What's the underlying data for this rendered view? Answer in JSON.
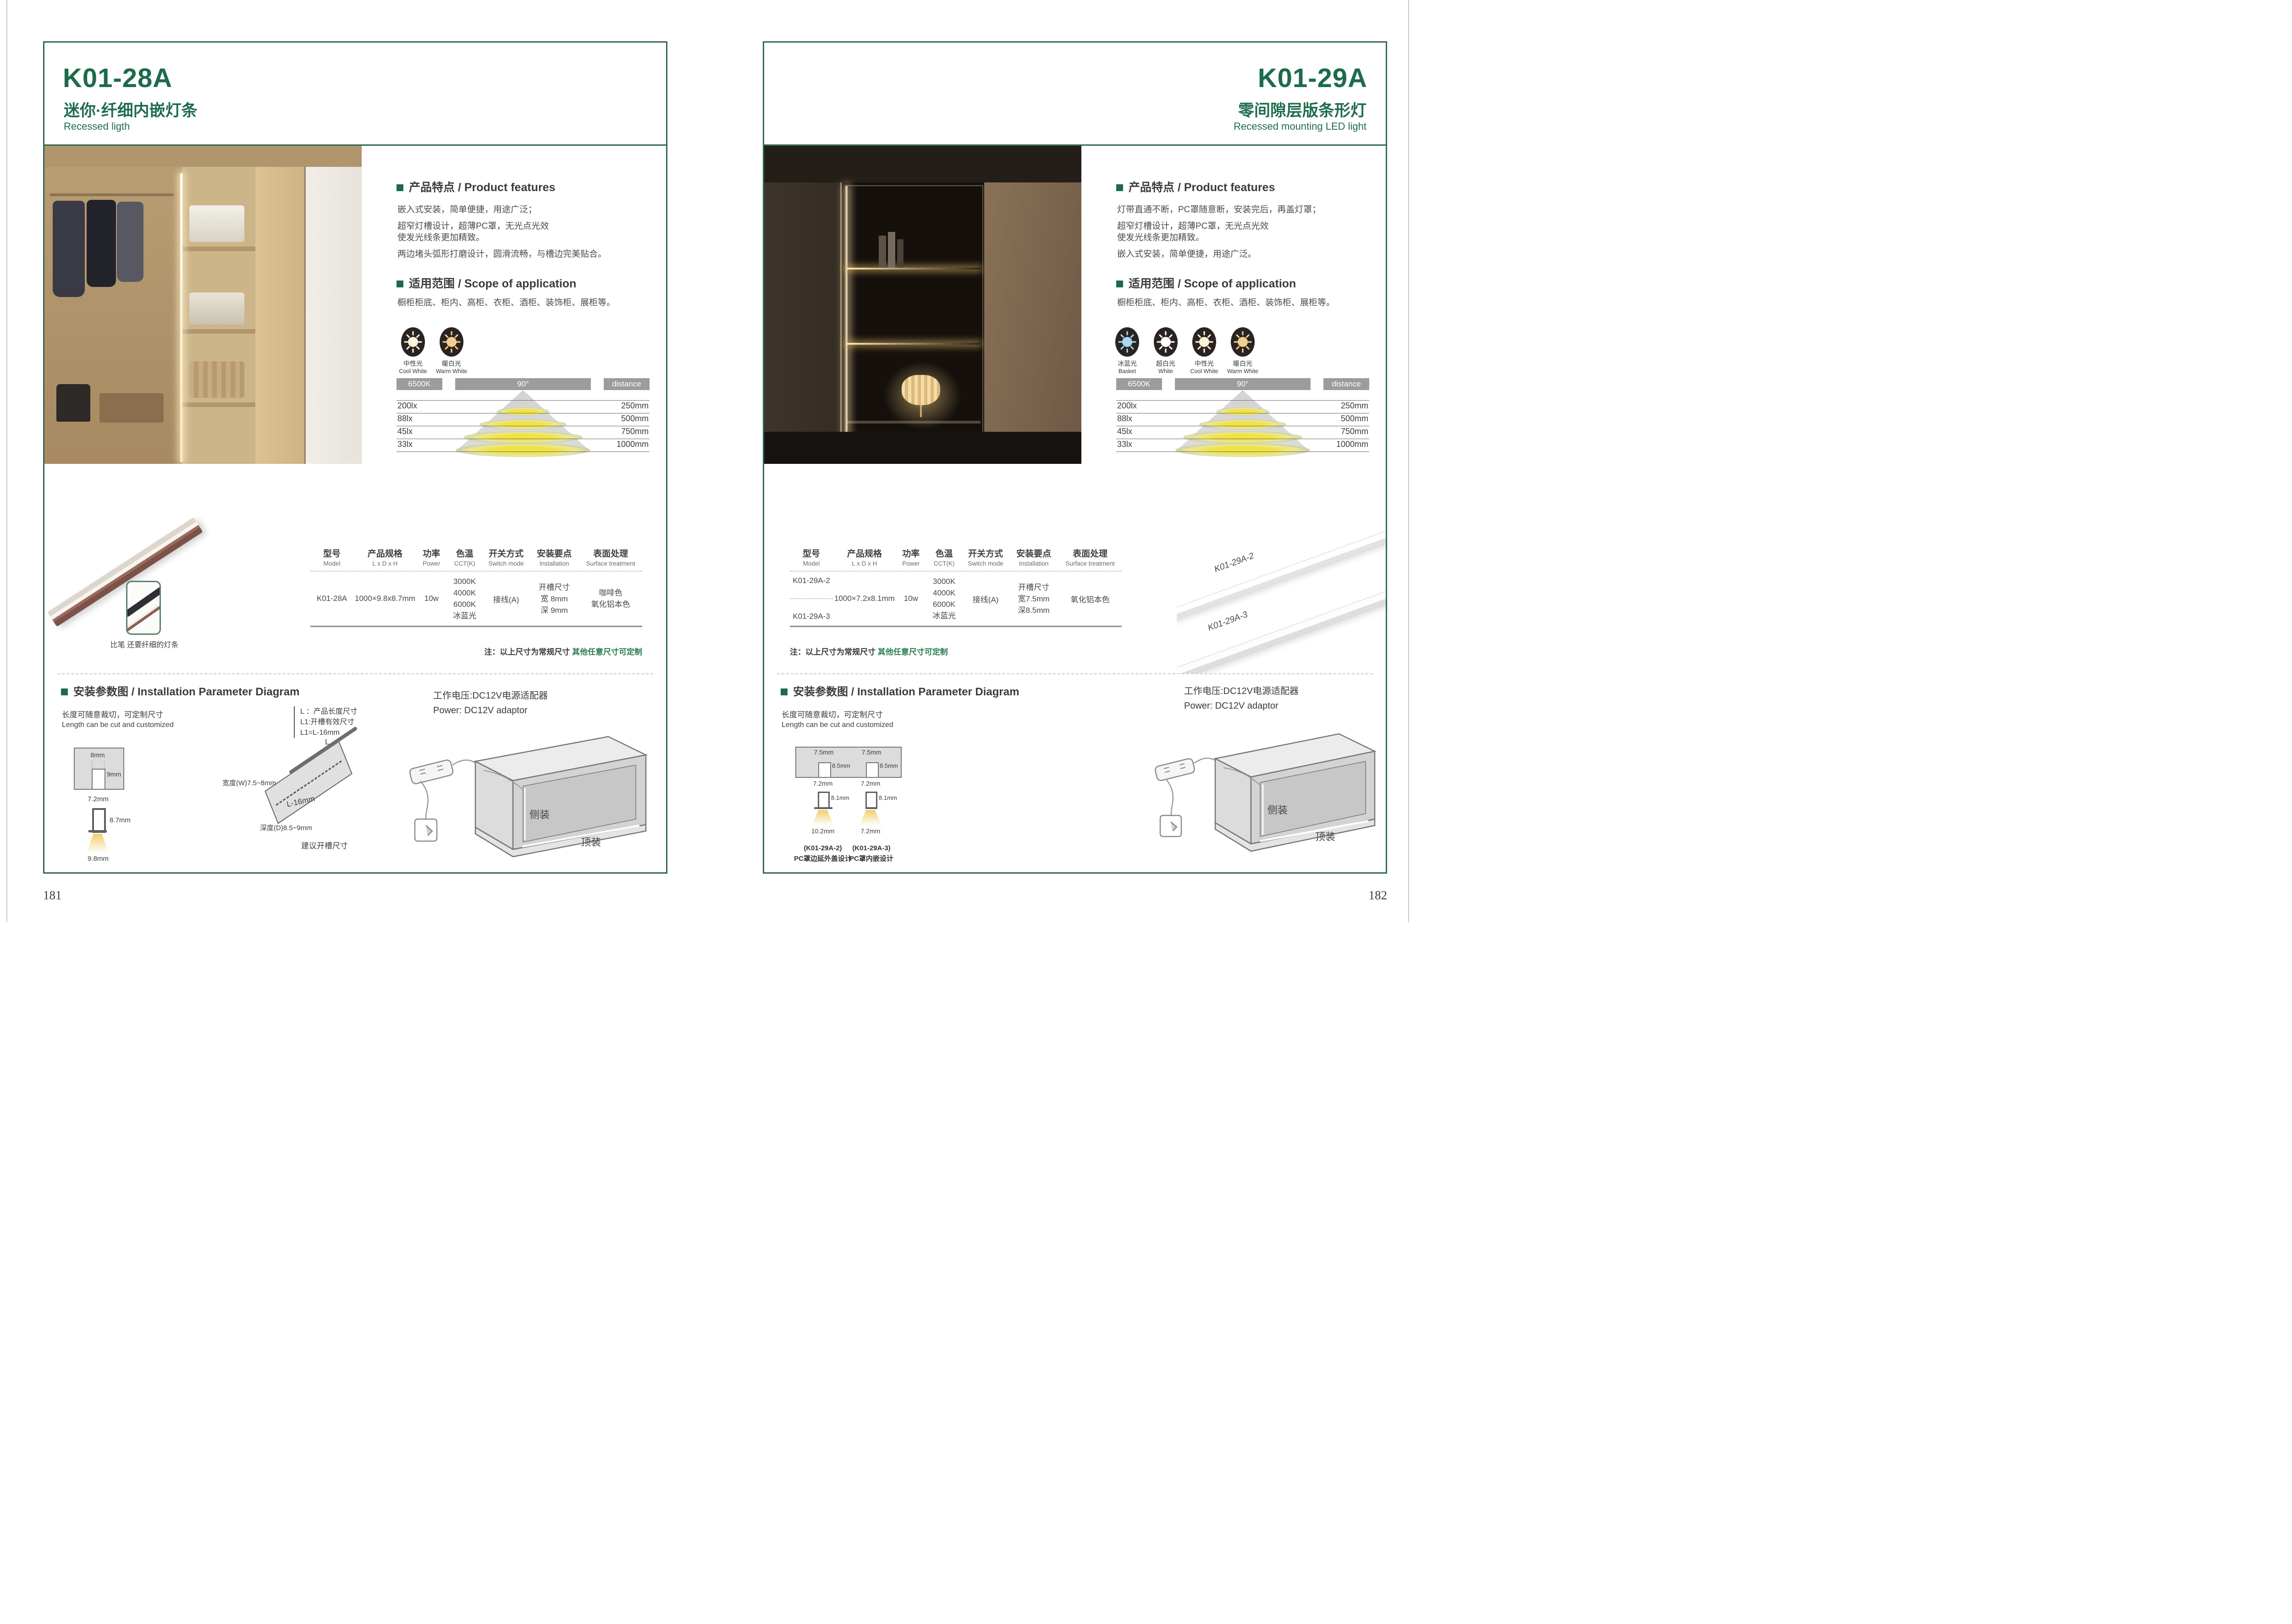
{
  "accent": {
    "green": "#1d6b4b",
    "green_border": "#2f6a51",
    "note_green": "#2a7a50",
    "bar_grey": "#9c9c9c",
    "text_dark": "#3d3d3d"
  },
  "photometric": {
    "cct": "6500K",
    "angle": "90°",
    "distance_label": "distance",
    "rows": [
      {
        "lux": "200lx",
        "mm": "250mm"
      },
      {
        "lux": "88lx",
        "mm": "500mm"
      },
      {
        "lux": "45lx",
        "mm": "750mm"
      },
      {
        "lux": "33lx",
        "mm": "1000mm"
      }
    ]
  },
  "table_headers": [
    {
      "cn": "型号",
      "en": "Model"
    },
    {
      "cn": "产品规格",
      "en": "L x D x H"
    },
    {
      "cn": "功率",
      "en": "Power"
    },
    {
      "cn": "色温",
      "en": "CCT(K)"
    },
    {
      "cn": "开关方式",
      "en": "Switch mode"
    },
    {
      "cn": "安装要点",
      "en": "Installation"
    },
    {
      "cn": "表面处理",
      "en": "Surface treatment"
    }
  ],
  "note": {
    "prefix": "注：以上尺寸为常规尺寸 ",
    "highlight": "其他任意尺寸可定制"
  },
  "left": {
    "model": "K01-28A",
    "title_cn": "迷你·纤细内嵌灯条",
    "title_en": "Recessed ligth",
    "features_heading": "产品特点 / Product features",
    "features": [
      "嵌入式安装，简单便捷，用途广泛；",
      "超窄灯槽设计，超薄PC罩，无光点光效",
      "使发光线条更加精致。",
      "两边堵头弧形打磨设计，圆滑流畅，与槽边完美贴合。"
    ],
    "scope_heading": "适用范围 / Scope of application",
    "scope": "橱柜柜底、柜内、高柜、衣柜、酒柜、装饰柜、展柜等。",
    "cct_icons": [
      {
        "cn": "中性光",
        "en": "Cool White",
        "color": "#fdf3d8"
      },
      {
        "cn": "暖白光",
        "en": "Warm White",
        "color": "#f3cf8d"
      }
    ],
    "table_row": {
      "model": "K01-28A",
      "size": "1000×9.8x8.7mm",
      "power": "10w",
      "cct": [
        "3000K",
        "4000K",
        "6000K",
        "冰蓝光"
      ],
      "switch": "接线(A)",
      "install": [
        "开槽尺寸",
        "宽 8mm",
        "深 9mm"
      ],
      "surface": [
        "咖啡色",
        "氧化铝本色"
      ]
    },
    "photo_caption": "比笔 还要纤细的灯条",
    "install": {
      "heading": "安装参数图 / Installation Parameter Diagram",
      "cut_cn": "长度可随意裁切，可定制尺寸",
      "cut_en": "Length can be cut and customized",
      "groove_w": "8mm",
      "groove_d": "9mm",
      "profile_w": "7.2mm",
      "profile_h": "8.7mm",
      "base_w": "9.8mm",
      "legend": [
        "L ：产品长度尺寸",
        "L1:开槽有效尺寸",
        "L1=L-16mm"
      ],
      "board_l": "L",
      "board_l16": "L-16mm",
      "board_w": "宽度(W)7.5~8mm",
      "board_d": "深度(D)8.5~9mm",
      "board_suggest": "建议开槽尺寸",
      "power_cn": "工作电压:DC12V电源适配器",
      "power_en": "Power: DC12V adaptor",
      "side_mount": "侧装",
      "top_mount": "顶装"
    },
    "page_number": "181"
  },
  "right": {
    "model": "K01-29A",
    "title_cn": "零间隙层版条形灯",
    "title_en": "Recessed mounting LED light",
    "features_heading": "产品特点 / Product features",
    "features": [
      "灯带直通不断，PC罩随意断，安装完后，再盖灯罩；",
      "超窄灯槽设计，超薄PC罩，无光点光效",
      "使发光线条更加精致。",
      "嵌入式安装，简单便捷，用途广泛。"
    ],
    "scope_heading": "适用范围 / Scope of application",
    "scope": "橱柜柜底、柜内、高柜、衣柜、酒柜、装饰柜、展柜等。",
    "cct_icons": [
      {
        "cn": "冰蓝光",
        "en": "Basket",
        "color": "#a9d9f2"
      },
      {
        "cn": "超白光",
        "en": "White",
        "color": "#ffffff"
      },
      {
        "cn": "中性光",
        "en": "Cool White",
        "color": "#fdf3d8"
      },
      {
        "cn": "暖白光",
        "en": "Warm White",
        "color": "#f3cf8d"
      }
    ],
    "table_models": [
      "K01-29A-2",
      "K01-29A-3"
    ],
    "table_row": {
      "size": "1000×7.2x8.1mm",
      "power": "10w",
      "cct": [
        "3000K",
        "4000K",
        "6000K",
        "冰蓝光"
      ],
      "switch": "接线(A)",
      "install": [
        "开槽尺寸",
        "宽7.5mm",
        "深8.5mm"
      ],
      "surface": [
        "氧化铝本色"
      ]
    },
    "profile_labels": [
      "K01-29A-2",
      "K01-29A-3"
    ],
    "install": {
      "heading": "安装参数图 / Installation Parameter Diagram",
      "cut_cn": "长度可随意裁切，可定制尺寸",
      "cut_en": "Length can be cut and customized",
      "sections": [
        {
          "groove_w": "7.5mm",
          "groove_d": "8.5mm",
          "profile_w": "7.2mm",
          "profile_h": "8.1mm",
          "base_w": "10.2mm",
          "model": "(K01-29A-2)",
          "desc": "PC罩边延外盖设计"
        },
        {
          "groove_w": "7.5mm",
          "groove_d": "8.5mm",
          "profile_w": "7.2mm",
          "profile_h": "8.1mm",
          "base_w": "7.2mm",
          "model": "(K01-29A-3)",
          "desc": "PC罩内嵌设计"
        }
      ],
      "power_cn": "工作电压:DC12V电源适配器",
      "power_en": "Power: DC12V adaptor",
      "side_mount": "侧装",
      "top_mount": "顶装"
    },
    "page_number": "182"
  }
}
